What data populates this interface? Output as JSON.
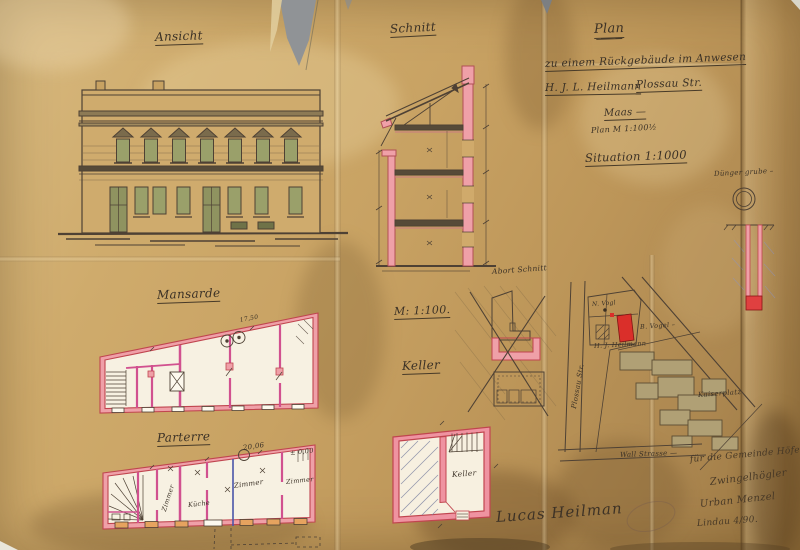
{
  "labels": {
    "ansicht": "Ansicht",
    "schnitt": "Schnitt",
    "mansarde": "Mansarde",
    "parterre": "Parterre",
    "scale": "M: 1:100.",
    "keller": "Keller",
    "abort_schnitt": "Abort Schnitt",
    "grube": "Dünger grube –"
  },
  "title_block": {
    "heading": "Plan",
    "line2": "zu einem Rückgebäude im Anwesen",
    "owner": "H. J. L. Heilmann",
    "street": "Plossau Str.",
    "line4": "Maas —",
    "line5": "Plan M 1:100½",
    "situation": "Situation 1:1000"
  },
  "mansarde": {
    "dim": "17,50"
  },
  "parterre": {
    "rooms": [
      "Zimmer",
      "Küche",
      "Zimmer",
      "Zimmer"
    ],
    "dim": "20,06",
    "level": "± 0,00"
  },
  "keller_plan": {
    "room": "Keller"
  },
  "site_plan": {
    "street_vertical": "Plossau Str.",
    "parcel1": "N. Vogl",
    "parcel2": "B. Vogel –",
    "parcel3": "H. J. Heilmann",
    "square": "Kaiserplatz",
    "street_bottom": "Wall Strasse —"
  },
  "signatures": {
    "line1": "für die Gemeinde Höfe",
    "line2": "Zwingelhögler",
    "line3": "Urban Menzel",
    "line4": "Lindau 4/90.",
    "owner": "Lucas Heilman"
  },
  "colors": {
    "paper": "#c8a263",
    "ink": "#4a3c2c",
    "wall_pink": "#efa0a8",
    "wall_crimson": "#c0454f",
    "partition_magenta": "#d1518f",
    "new_building_red": "#da2f2a",
    "window_green": "#9aa06a",
    "block_tan": "#b0a075",
    "line_blue": "#4a55a8"
  }
}
